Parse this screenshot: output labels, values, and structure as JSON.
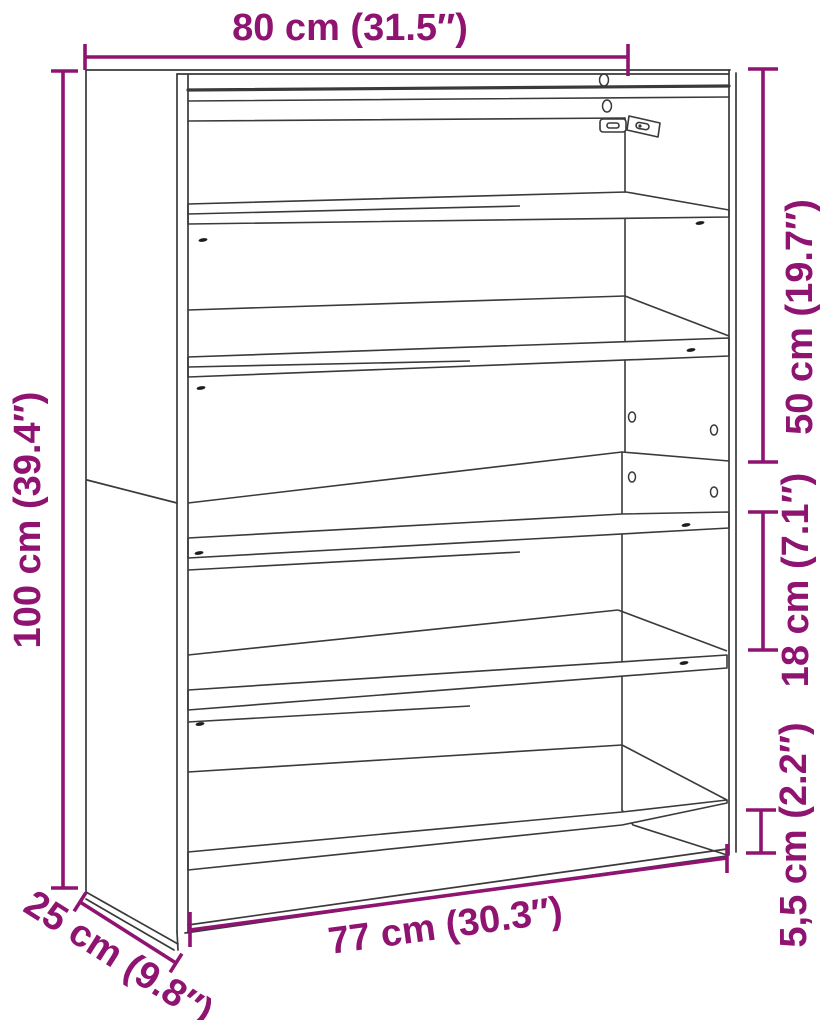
{
  "diagram": {
    "kind": "furniture-dimension-diagram",
    "subject": "wall-mounted shoe rack with five slanted shelves, two stacked sections, shown in perspective line art",
    "colors": {
      "dimension_accent": "#8F1371",
      "drawing_line": "#3a3a3a",
      "background": "#ffffff"
    },
    "dimensions": {
      "width_top": "80 cm (31.5″)",
      "height_left": "100 cm (39.4″)",
      "upper_section_right": "50 cm (19.7″)",
      "shelf_gap_right": "18 cm (7.1″)",
      "bottom_gap_right": "5,5 cm (2.2″)",
      "width_bottom": "77 cm (30.3″)",
      "depth_bottom_left": "25 cm (9.8″)"
    }
  }
}
